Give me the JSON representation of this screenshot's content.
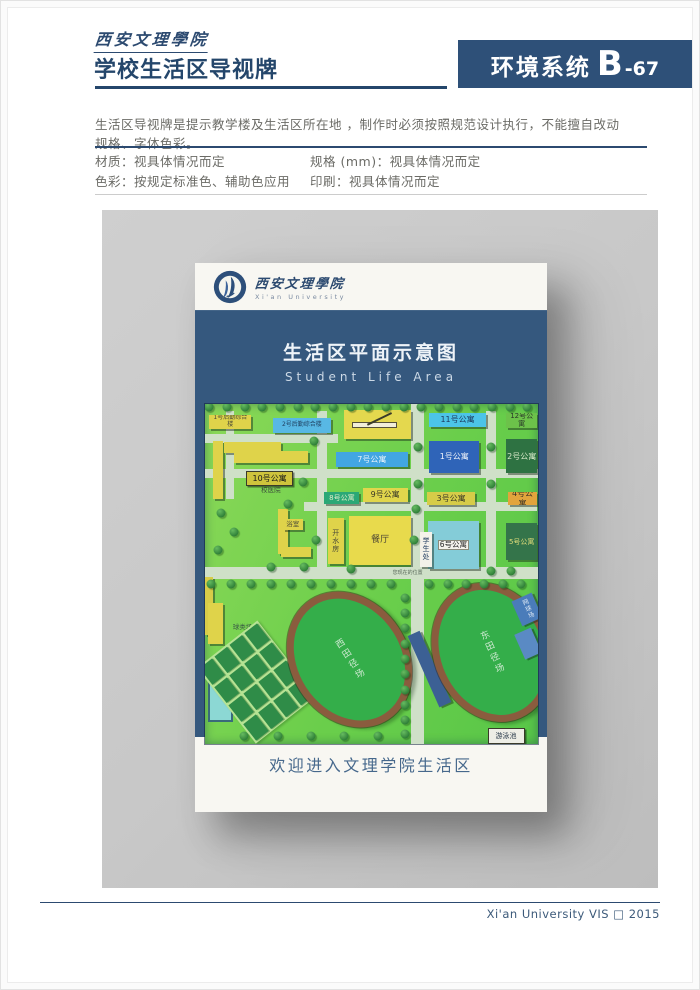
{
  "page": {
    "brand_calligraphy": "西安文理學院",
    "title": "学校生活区导视牌",
    "code_box": {
      "system": "环境系统",
      "letter": "B",
      "number": "-67"
    },
    "description": "生活区导视牌是提示教学楼及生活区所在地 ，制作时必须按照规范设计执行，不能擅自改动规格、字体色彩。",
    "specs": {
      "material": "材质：视具体情况而定",
      "size": "规格 (mm)：视具体情况而定",
      "color": "色彩：按规定标准色、辅助色应用",
      "print": "印刷：视具体情况而定"
    },
    "footer_credit": "Xi'an University VIS □ 2015"
  },
  "sign": {
    "logo_cn": "西安文理學院",
    "logo_en": "Xi'an University",
    "panel_title": "生活区平面示意图",
    "panel_subtitle": "Student Life Area",
    "welcome": "欢迎进入文理学院生活区"
  },
  "colors": {
    "navy": "#24466b",
    "code_box_bg": "#2e5078",
    "panel_blue": "#35587e",
    "stage_gray": "#c8c8c8",
    "card_bg": "#f8f7f2",
    "map_green": "#6ace4b",
    "track_ring_brown": "#8a5c3e",
    "track_infield_green": "#34ae4a"
  },
  "map": {
    "roads": [
      {
        "x": 0,
        "y": 8.8,
        "w": 40,
        "h": 2.8
      },
      {
        "x": 0,
        "y": 19,
        "w": 100,
        "h": 2.8
      },
      {
        "x": 30,
        "y": 28.8,
        "w": 70,
        "h": 2.6
      },
      {
        "x": 0,
        "y": 48,
        "w": 100,
        "h": 3.4
      },
      {
        "x": 6.5,
        "y": 2,
        "w": 2.4,
        "h": 26
      },
      {
        "x": 33.8,
        "y": 2,
        "w": 3,
        "h": 46
      },
      {
        "x": 62,
        "y": 0,
        "w": 4,
        "h": 100
      },
      {
        "x": 84.5,
        "y": 2,
        "w": 3,
        "h": 46
      }
    ],
    "features": [
      {
        "type": "text",
        "label": "您现在的位置",
        "x": 56.5,
        "y": 48.4,
        "w": 14,
        "h": 2.5,
        "fs": 5,
        "fg": "#5a6a5a"
      },
      {
        "label": "",
        "x": 2.5,
        "y": 11,
        "w": 3,
        "h": 17,
        "bg": "#dfd34a"
      },
      {
        "label": "1号后勤综合楼",
        "x": 1.5,
        "y": 3.2,
        "w": 12.5,
        "h": 4.2,
        "bg": "#dfd34a",
        "fg": "#4a4a38",
        "fs": 6
      },
      {
        "label": "2号后勤综合楼",
        "x": 20.5,
        "y": 4,
        "w": 17.5,
        "h": 4.4,
        "bg": "#58b8e4",
        "fg": "#1e3c5c",
        "fs": 6
      },
      {
        "label": "",
        "x": 42,
        "y": 1.8,
        "w": 20,
        "h": 8.5,
        "bg": "#e4d84e",
        "cls": "arrow"
      },
      {
        "label": "11号公寓",
        "x": 67.5,
        "y": 2.5,
        "w": 17,
        "h": 4.2,
        "bg": "#4cc4e8",
        "fg": "#1d3a5e",
        "fs": 8
      },
      {
        "label": "12号公寓",
        "x": 90.5,
        "y": 2.5,
        "w": 9.5,
        "h": 4.6,
        "bg": "#6cc24a",
        "fg": "#2a3a2a",
        "fs": 7
      },
      {
        "label": "",
        "x": 6,
        "y": 11.2,
        "w": 17,
        "h": 3.2,
        "bg": "#dfd34a"
      },
      {
        "label": "",
        "x": 9,
        "y": 13.8,
        "w": 22,
        "h": 3.6,
        "bg": "#dfd34a"
      },
      {
        "label": "7号公寓",
        "x": 39.5,
        "y": 14.2,
        "w": 21.5,
        "h": 4.4,
        "bg": "#42a6e2",
        "fg": "#e8f2fa",
        "fs": 8
      },
      {
        "label": "1号公寓",
        "x": 67.5,
        "y": 10.8,
        "w": 15,
        "h": 9.6,
        "bg": "#2f64b8",
        "fg": "#f0f4fa",
        "fs": 8,
        "cls": "bars"
      },
      {
        "label": "2号公寓",
        "x": 90.5,
        "y": 10.4,
        "w": 9.5,
        "h": 10,
        "bg": "#2e7242",
        "fg": "#d8e8c8",
        "fs": 8,
        "cls": "bars"
      },
      {
        "label": "10号公寓",
        "x": 12.5,
        "y": 19.8,
        "w": 13.5,
        "h": 3.8,
        "bg": "#cfc43c",
        "fg": "#1a1a1a",
        "fs": 8,
        "cls": "chip"
      },
      {
        "type": "text",
        "label": "校医院",
        "x": 17,
        "y": 23.6,
        "w": 10,
        "h": 2.5,
        "fs": 6.5,
        "fg": "#3a4a3a"
      },
      {
        "label": "8号公寓",
        "x": 36,
        "y": 26,
        "w": 10.5,
        "h": 3.4,
        "bg": "#2aa876",
        "fg": "#e0ecc8",
        "fs": 7
      },
      {
        "label": "9号公寓",
        "x": 47.5,
        "y": 24.6,
        "w": 13.5,
        "h": 4.2,
        "bg": "#e0d64c",
        "fg": "#3a3a28",
        "fs": 8
      },
      {
        "label": "3号公寓",
        "x": 66.8,
        "y": 26,
        "w": 14.5,
        "h": 3.6,
        "bg": "#d6cc48",
        "fg": "#3a3a28",
        "fs": 8
      },
      {
        "label": "4号公寓",
        "x": 91,
        "y": 26,
        "w": 9,
        "h": 3.6,
        "bg": "#e2a43c",
        "fg": "#3a3226",
        "fs": 8
      },
      {
        "label": "",
        "x": 22,
        "y": 31,
        "w": 3,
        "h": 13,
        "bg": "#dfd34a"
      },
      {
        "label": "",
        "x": 23,
        "y": 42,
        "w": 9,
        "h": 3,
        "bg": "#dfd34a"
      },
      {
        "label": "浴室",
        "x": 23.5,
        "y": 33.8,
        "w": 6,
        "h": 3.4,
        "bg": "#dfd34a",
        "fg": "#4a4a38",
        "fs": 6.5
      },
      {
        "label": "开水房",
        "x": 37,
        "y": 33.5,
        "w": 4.8,
        "h": 13.5,
        "bg": "#dfd34a",
        "fg": "#4a4a38",
        "fs": 7,
        "cls": "vert"
      },
      {
        "label": "餐厅",
        "x": 43.5,
        "y": 32.8,
        "w": 18.5,
        "h": 14.5,
        "bg": "#e8da4c",
        "fg": "#4a4434",
        "fs": 9
      },
      {
        "label": "6号公寓",
        "x": 67,
        "y": 34.5,
        "w": 15.5,
        "h": 14,
        "bg": "#84ccd8",
        "fg": "#2a2a2a",
        "fs": 7.5,
        "cls": "chipinside"
      },
      {
        "label": "学生处",
        "x": 64.6,
        "y": 37.5,
        "w": 3.8,
        "h": 10.5,
        "bg": "#f4f2ea",
        "fg": "#1e3a5e",
        "fs": 7,
        "cls": "vert"
      },
      {
        "label": "5号公寓",
        "x": 90.5,
        "y": 35,
        "w": 9.5,
        "h": 11,
        "bg": "#34744a",
        "fg": "#e0dc7a",
        "fs": 7
      },
      {
        "label": "",
        "x": 0,
        "y": 51,
        "w": 2.5,
        "h": 17,
        "bg": "#d8cc48"
      },
      {
        "label": "",
        "x": 1,
        "y": 58.5,
        "w": 4.5,
        "h": 12,
        "bg": "#dfd34a"
      },
      {
        "label": "",
        "x": 1,
        "y": 81.5,
        "w": 6.5,
        "h": 11,
        "bg": "#8cd8d4",
        "cls": "pool"
      },
      {
        "type": "text",
        "label": "球类场地",
        "x": 8.5,
        "y": 63.8,
        "w": 12,
        "h": 2.5,
        "fs": 6.5,
        "fg": "#3a5a46"
      },
      {
        "type": "grid",
        "x": 4,
        "y": 67.5,
        "w": 22,
        "h": 27,
        "rot": -38
      },
      {
        "type": "track",
        "label": "西田径场",
        "x": 26,
        "y": 54,
        "w": 31,
        "h": 38,
        "rot": -33
      },
      {
        "label": "",
        "x": 65.6,
        "y": 66.5,
        "w": 4,
        "h": 23,
        "bg": "#3c6094",
        "rot": -24
      },
      {
        "type": "track",
        "label": "东田径场",
        "x": 69,
        "y": 52,
        "w": 30.5,
        "h": 38,
        "rot": -24
      },
      {
        "label": "网球场",
        "x": 93.5,
        "y": 56.5,
        "w": 6.5,
        "h": 8,
        "bg": "#4a7cba",
        "fg": "#dde8f4",
        "fs": 6,
        "cls": "vert",
        "rot": -24
      },
      {
        "label": "",
        "x": 94.5,
        "y": 66.5,
        "w": 5.5,
        "h": 8,
        "bg": "#5a8ac4",
        "rot": -24
      },
      {
        "label": "游泳池",
        "x": 85,
        "y": 95.3,
        "w": 10.5,
        "h": 4,
        "bg": "#eeeee6",
        "fg": "#2a3a4a",
        "fs": 7,
        "cls": "chip"
      }
    ],
    "trees": [
      [
        1.5,
        0.8
      ],
      [
        6.8,
        0.8
      ],
      [
        12.1,
        0.8
      ],
      [
        17.4,
        0.8
      ],
      [
        22.7,
        0.8
      ],
      [
        28,
        0.8
      ],
      [
        33.3,
        0.8
      ],
      [
        38.6,
        0.8
      ],
      [
        43.9,
        0.8
      ],
      [
        49.2,
        0.8
      ],
      [
        54.5,
        0.8
      ],
      [
        59.8,
        0.8
      ],
      [
        65.1,
        0.8
      ],
      [
        70.4,
        0.8
      ],
      [
        75.7,
        0.8
      ],
      [
        81,
        0.8
      ],
      [
        86.3,
        0.8
      ],
      [
        91.6,
        0.8
      ],
      [
        96.9,
        0.8
      ],
      [
        2,
        52.8
      ],
      [
        8,
        52.8
      ],
      [
        14,
        52.8
      ],
      [
        20,
        52.8
      ],
      [
        26,
        52.8
      ],
      [
        32,
        52.8
      ],
      [
        38,
        52.8
      ],
      [
        44,
        52.8
      ],
      [
        50,
        52.8
      ],
      [
        56,
        52.8
      ],
      [
        67.5,
        52.8
      ],
      [
        73,
        52.8
      ],
      [
        78.5,
        52.8
      ],
      [
        84,
        52.8
      ],
      [
        89.5,
        52.8
      ],
      [
        95,
        52.8
      ],
      [
        60.3,
        57
      ],
      [
        60.3,
        61.5
      ],
      [
        60.3,
        66
      ],
      [
        60.3,
        70.5
      ],
      [
        60.3,
        75
      ],
      [
        60.3,
        79.5
      ],
      [
        60.3,
        84
      ],
      [
        60.3,
        88.5
      ],
      [
        60.3,
        93
      ],
      [
        60.3,
        97
      ],
      [
        33,
        11
      ],
      [
        29.5,
        23
      ],
      [
        25,
        29.5
      ],
      [
        64,
        12.5
      ],
      [
        64,
        23.5
      ],
      [
        86,
        12.5
      ],
      [
        86,
        23.5
      ],
      [
        5,
        32
      ],
      [
        9,
        37.5
      ],
      [
        4,
        43
      ],
      [
        33.5,
        40
      ],
      [
        63,
        40
      ],
      [
        63.5,
        31
      ],
      [
        20,
        48
      ],
      [
        30,
        48
      ],
      [
        44,
        48.5
      ],
      [
        86,
        49
      ],
      [
        92,
        49
      ],
      [
        12,
        97.5
      ],
      [
        22,
        97.5
      ],
      [
        32,
        97.5
      ],
      [
        42,
        97.5
      ],
      [
        52,
        97.5
      ]
    ]
  }
}
